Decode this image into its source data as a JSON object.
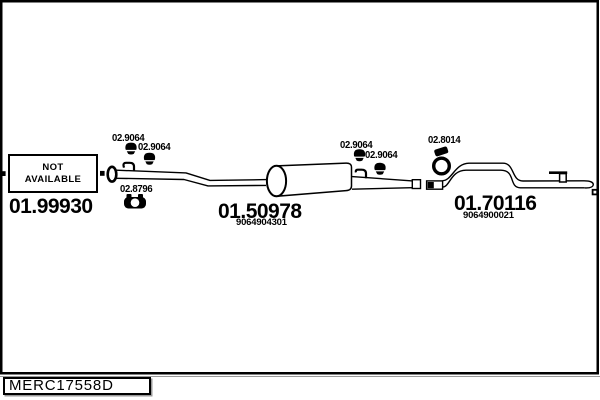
{
  "diagram": {
    "footer": {
      "drawing_code": "MERC17558D"
    },
    "not_available_box": {
      "line1": "NOT",
      "line2": "AVAILABLE"
    },
    "sections": {
      "front_pipe": {
        "part_code": "01.99930"
      },
      "centre_muffler": {
        "part_code": "01.50978",
        "oem_ref": "9064904301"
      },
      "rear_pipe": {
        "part_code": "01.70116",
        "oem_ref": "9064900021"
      }
    },
    "fitting_labels": {
      "front_hanger_1": "02.9064",
      "front_hanger_2": "02.9064",
      "front_clamp": "02.8796",
      "mid_hanger_1": "02.9064",
      "mid_hanger_2": "02.9064",
      "rear_clamp": "02.8014"
    },
    "colors": {
      "line": "#000000",
      "background": "#ffffff",
      "shadow": "#999999"
    }
  }
}
